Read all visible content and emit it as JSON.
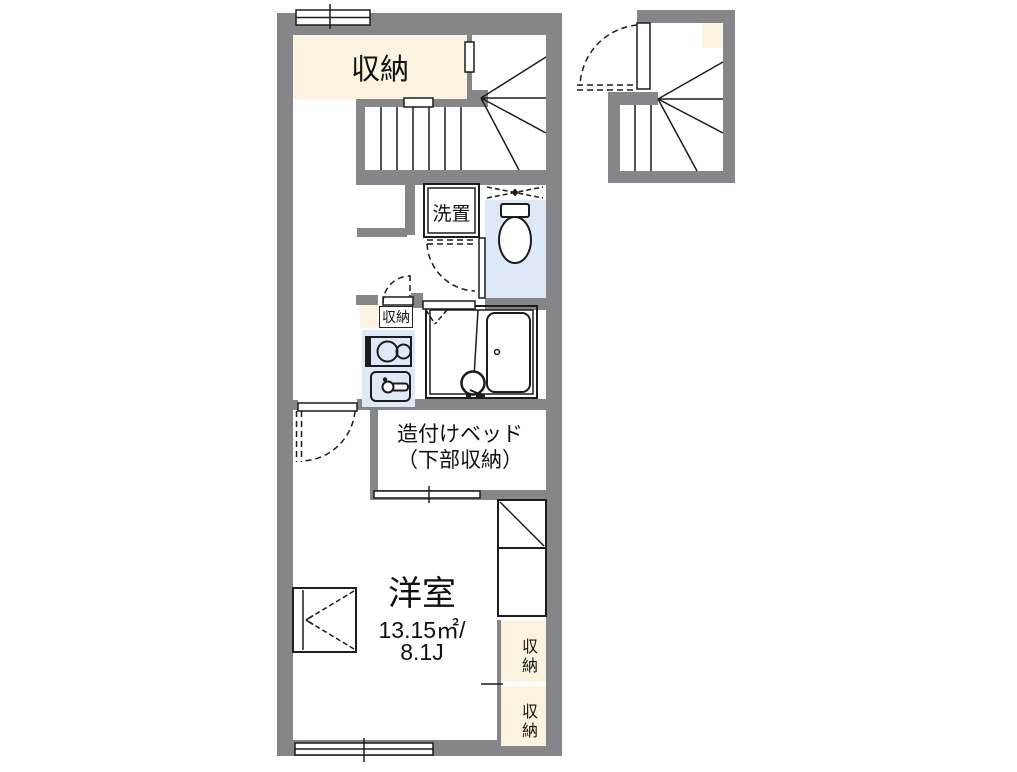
{
  "palette": {
    "wall_gray": "#86868a",
    "storage_cream": "#fbf2df",
    "fixture_blue": "#dde9f6",
    "bathtub_blue": "#eaf2fb",
    "line_dark": "#1c1c1c"
  },
  "plan": {
    "storage_top": {
      "label": "収納"
    },
    "laundry": {
      "label": "洗置"
    },
    "storage_small": {
      "label": "収納"
    },
    "built_in_bed": {
      "line1": "造付けベッド",
      "line2": "（下部収納）"
    },
    "western_room": {
      "name": "洋室",
      "area_sqm": "13.15㎡/",
      "area_tatami": "8.1J"
    },
    "closet_upper": {
      "label": "収納"
    },
    "closet_lower": {
      "label": "収納"
    }
  }
}
